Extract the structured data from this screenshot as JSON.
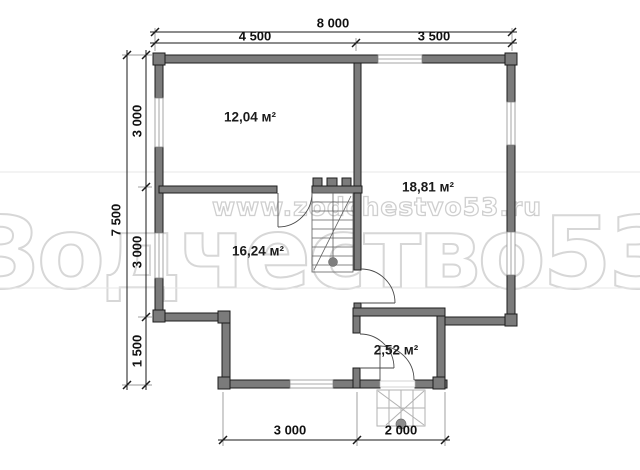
{
  "watermark": {
    "brand_text": "Зодчество53",
    "url_text": "www.zodchestvo53.ru"
  },
  "dimensions": {
    "top_total": "8 000",
    "top_left": "4 500",
    "top_right": "3 500",
    "left_total": "7 500",
    "left_upper": "3 000",
    "left_middle": "3 000",
    "left_lower": "1 500",
    "bottom_left": "3 000",
    "bottom_right": "2 000"
  },
  "rooms": [
    {
      "id": "room-top-left",
      "area": "12,04 м²"
    },
    {
      "id": "room-right",
      "area": "18,81 м²"
    },
    {
      "id": "room-bottom-left",
      "area": "16,24 м²"
    },
    {
      "id": "room-entry",
      "area": "2,52 м²"
    }
  ],
  "colors": {
    "wall_fill": "#7b7b7b",
    "wall_outline": "#1c1c1c",
    "watermark": "#d7d7d7",
    "dimension_text": "#111111"
  }
}
